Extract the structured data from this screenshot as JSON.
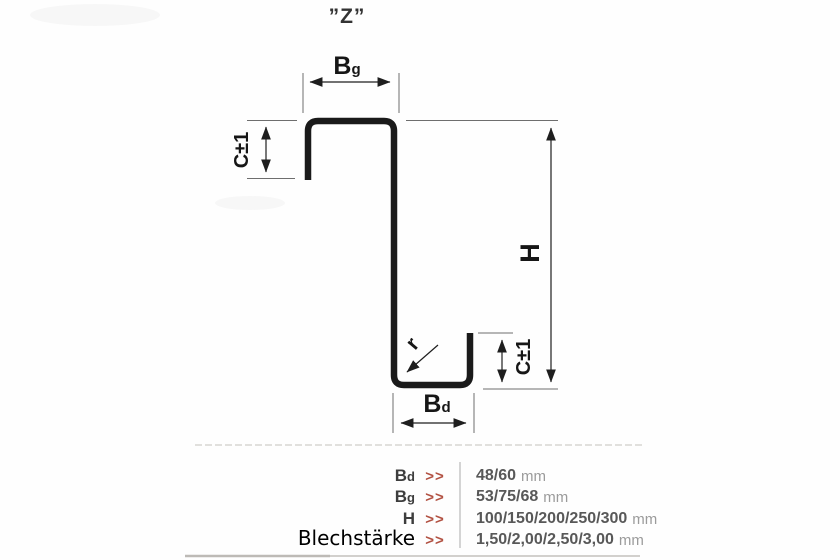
{
  "title": "”Z”",
  "diagram": {
    "bg_label": {
      "base": "B",
      "sub": "g"
    },
    "bd_label": {
      "base": "B",
      "sub": "d"
    },
    "h_label": "H",
    "c_left_label": "C±1",
    "c_right_label": "C±1",
    "r_label": "r"
  },
  "spec_table": {
    "chevron": ">>",
    "accent_color": "#b25142",
    "rows": [
      {
        "label_base": "B",
        "label_sub": "d",
        "value": "48/60",
        "unit": "mm"
      },
      {
        "label_base": "B",
        "label_sub": "g",
        "value": "53/75/68",
        "unit": "mm"
      },
      {
        "label_base": "H",
        "label_sub": "",
        "value": "100/150/200/250/300",
        "unit": "mm"
      },
      {
        "label_base": "Blechstärke",
        "label_sub": "",
        "value": "1,50/2,00/2,50/3,00",
        "unit": "mm"
      }
    ]
  }
}
